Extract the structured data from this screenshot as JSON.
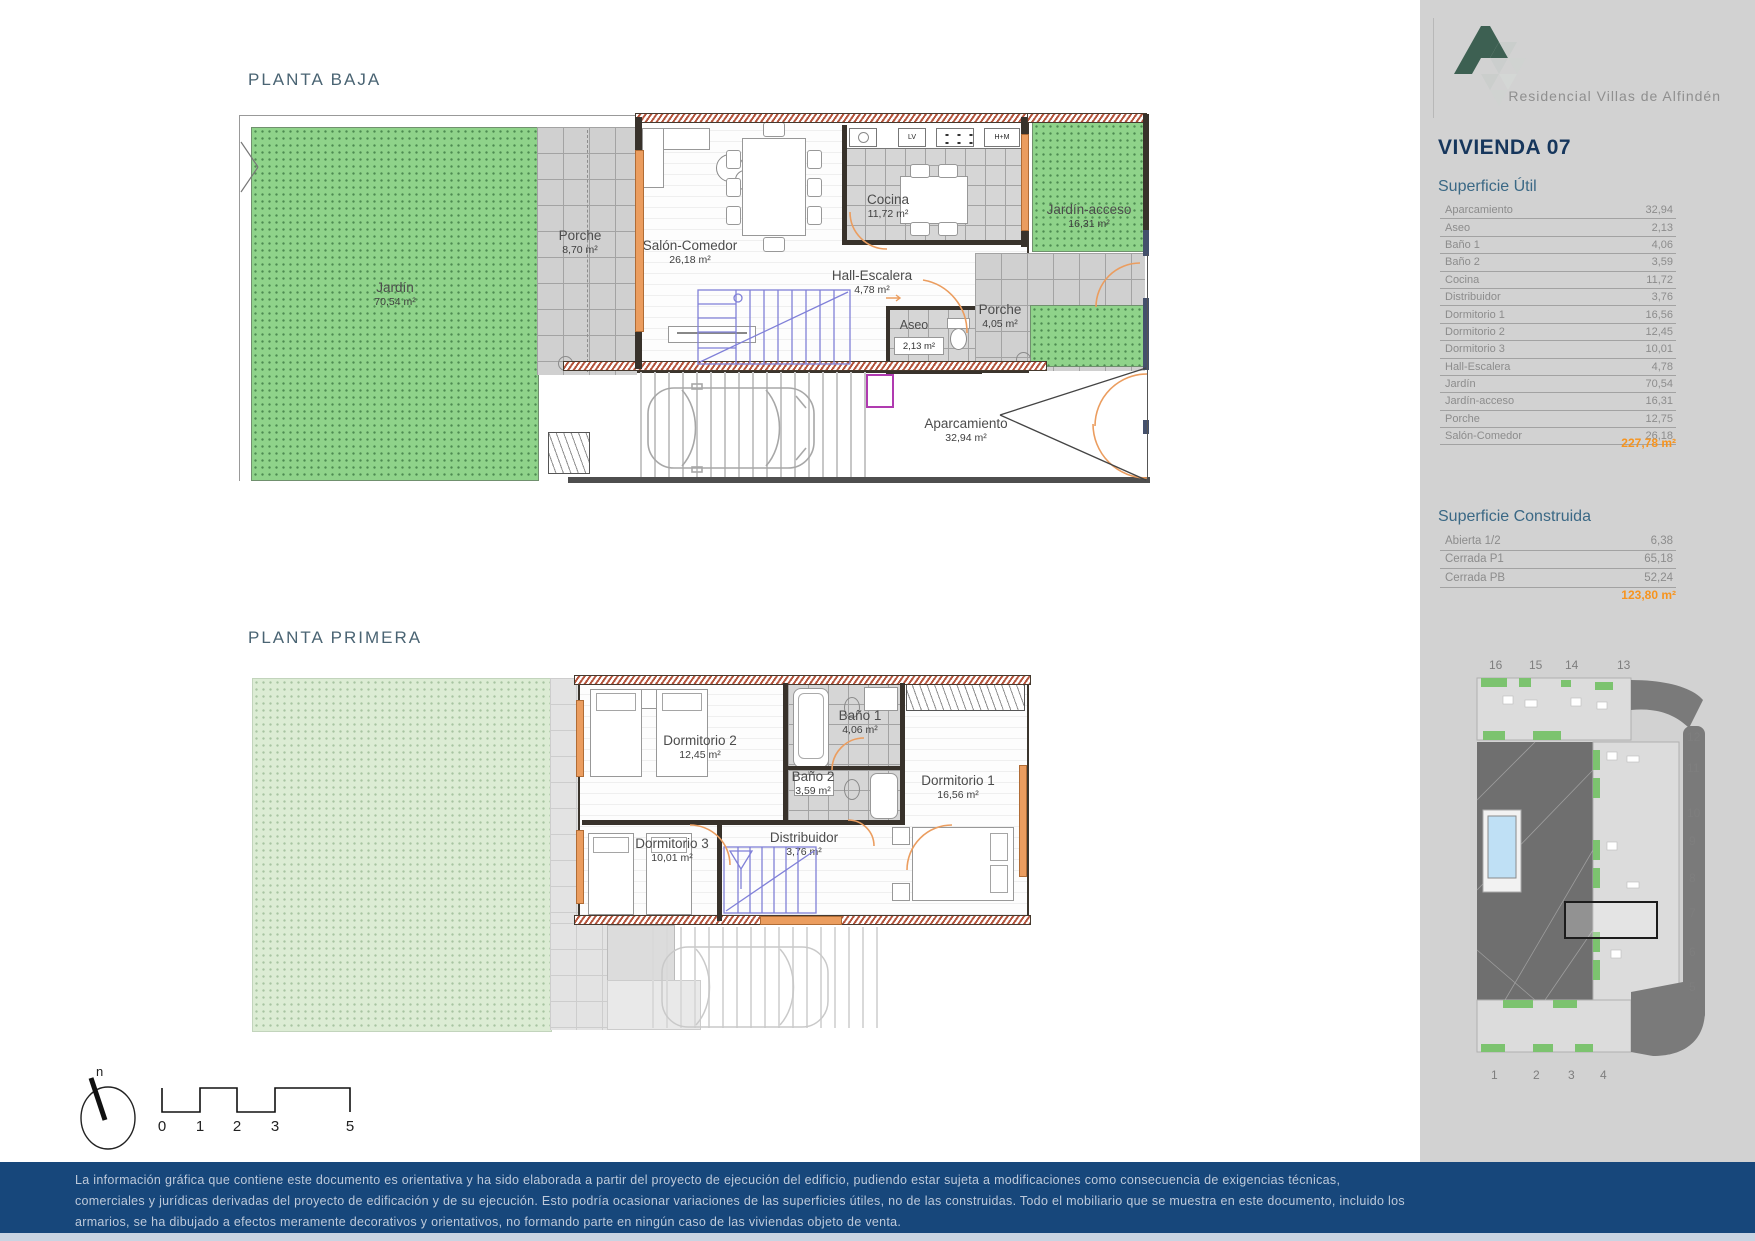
{
  "brand": {
    "name": "Residencial Villas de Alfindén"
  },
  "unit": {
    "title": "VIVIENDA 07"
  },
  "superficie_util": {
    "heading": "Superficie Útil",
    "rows": [
      {
        "label": "Aparcamiento",
        "value": "32,94"
      },
      {
        "label": "Aseo",
        "value": "2,13"
      },
      {
        "label": "Baño 1",
        "value": "4,06"
      },
      {
        "label": "Baño 2",
        "value": "3,59"
      },
      {
        "label": "Cocina",
        "value": "11,72"
      },
      {
        "label": "Distribuidor",
        "value": "3,76"
      },
      {
        "label": "Dormitorio 1",
        "value": "16,56"
      },
      {
        "label": "Dormitorio 2",
        "value": "12,45"
      },
      {
        "label": "Dormitorio 3",
        "value": "10,01"
      },
      {
        "label": "Hall-Escalera",
        "value": "4,78"
      },
      {
        "label": "Jardín",
        "value": "70,54"
      },
      {
        "label": "Jardín-acceso",
        "value": "16,31"
      },
      {
        "label": "Porche",
        "value": "12,75"
      },
      {
        "label": "Salón-Comedor",
        "value": "26,18"
      }
    ],
    "total": "227,78 m²"
  },
  "superficie_construida": {
    "heading": "Superficie Construida",
    "rows": [
      {
        "label": "Abierta 1/2",
        "value": "6,38"
      },
      {
        "label": "Cerrada P1",
        "value": "65,18"
      },
      {
        "label": "Cerrada PB",
        "value": "52,24"
      }
    ],
    "total": "123,80 m²"
  },
  "planta_baja": {
    "title": "PLANTA BAJA",
    "rooms": {
      "jardin": {
        "name": "Jardín",
        "area": "70,54 m²"
      },
      "porche": {
        "name": "Porche",
        "area": "8,70 m²"
      },
      "salon": {
        "name": "Salón-Comedor",
        "area": "26,18 m²"
      },
      "cocina": {
        "name": "Cocina",
        "area": "11,72 m²"
      },
      "jardin_acceso": {
        "name": "Jardín-acceso",
        "area": "16,31 m²"
      },
      "hall": {
        "name": "Hall-Escalera",
        "area": "4,78 m²"
      },
      "aseo": {
        "name": "Aseo",
        "area": "2,13 m²"
      },
      "porche2": {
        "name": "Porche",
        "area": "4,05 m²"
      },
      "aparcamiento": {
        "name": "Aparcamiento",
        "area": "32,94 m²"
      }
    },
    "appliances": {
      "lv": "LV",
      "hm": "H+M"
    }
  },
  "planta_primera": {
    "title": "PLANTA PRIMERA",
    "rooms": {
      "dormitorio2": {
        "name": "Dormitorio 2",
        "area": "12,45 m²"
      },
      "bano1": {
        "name": "Baño 1",
        "area": "4,06 m²"
      },
      "dormitorio1": {
        "name": "Dormitorio 1",
        "area": "16,56 m²"
      },
      "bano2": {
        "name": "Baño 2",
        "area": "3,59 m²"
      },
      "dormitorio3": {
        "name": "Dormitorio 3",
        "area": "10,01 m²"
      },
      "distribuidor": {
        "name": "Distribuidor",
        "area": "3,76 m²"
      }
    }
  },
  "site_map": {
    "top_labels": [
      "16",
      "15",
      "14",
      "13"
    ],
    "right_labels": [
      "12",
      "11",
      "10",
      "9",
      "8",
      "7",
      "6",
      "5"
    ],
    "bottom_labels": [
      "1",
      "2",
      "3",
      "4"
    ],
    "highlighted_unit": "7"
  },
  "scale": {
    "north": "n",
    "ticks": [
      "0",
      "1",
      "2",
      "3",
      "5"
    ]
  },
  "footer": {
    "lines": [
      "La información gráfica que contiene este documento es orientativa y ha sido elaborada a partir del proyecto de ejecución del edificio, pudiendo estar sujeta a modificaciones como consecuencia de exigencias técnicas,",
      "comerciales y jurídicas derivadas del proyecto de edificación y de su ejecución. Esto podría ocasionar variaciones de las superficies útiles, no de las construidas. Todo el mobiliario que se muestra en este documento, incluido los",
      "armarios, se ha dibujado a efectos meramente decorativos y orientativos, no formando parte en ningún caso de las viviendas objeto de venta."
    ]
  },
  "colors": {
    "accent_orange": "#f7941e",
    "footer_blue": "#17477b",
    "garden_green": "#8fd38a",
    "logo_green": "#3d6052",
    "sidebar_gray": "#d2d2d2"
  }
}
